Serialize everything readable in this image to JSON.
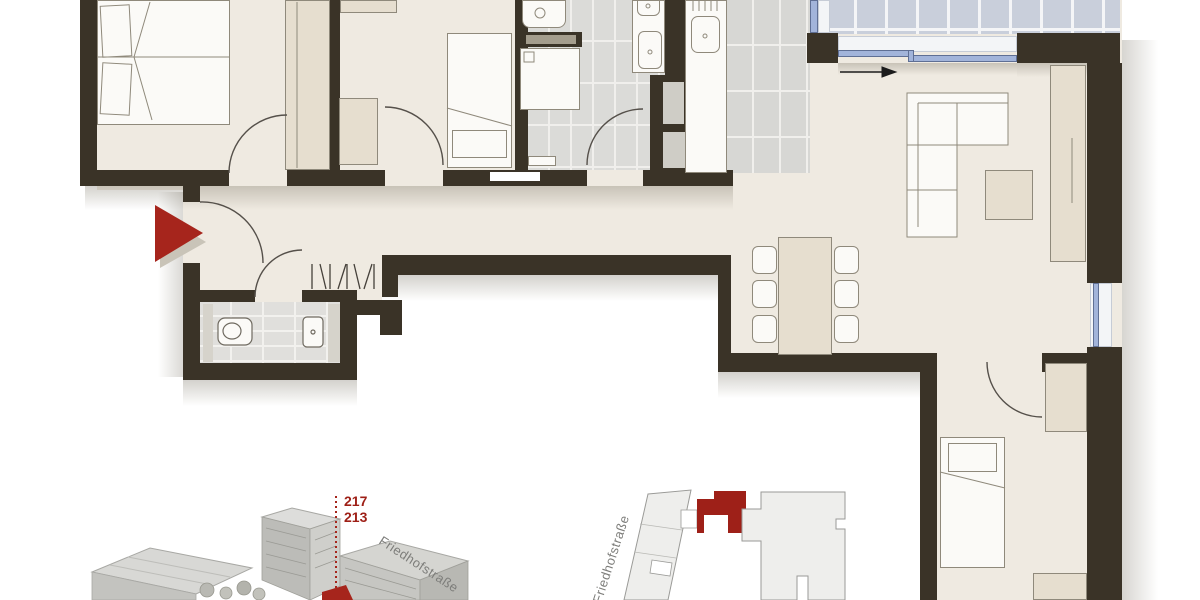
{
  "document": {
    "kind": "apartment floor plan with location insets",
    "visible_text_only": true
  },
  "insets": {
    "aerial_3d": {
      "building_number_top": "217",
      "building_number_bottom": "213",
      "street_label": "Friedhofstraße"
    },
    "site_plan": {
      "street_label": "Friedhofstraße"
    }
  },
  "colors": {
    "wall": "#3a3327",
    "floor": "#efeae1",
    "furniture_beige": "#e6decf",
    "furniture_white": "#fbfaf7",
    "tile_gray": "#dbdbd8",
    "balcony_tile": "#c9cfdb",
    "window_blue": "#a2b4da",
    "accent_red": "#a6251c",
    "inset_building_gray": "#c6c6c3"
  }
}
